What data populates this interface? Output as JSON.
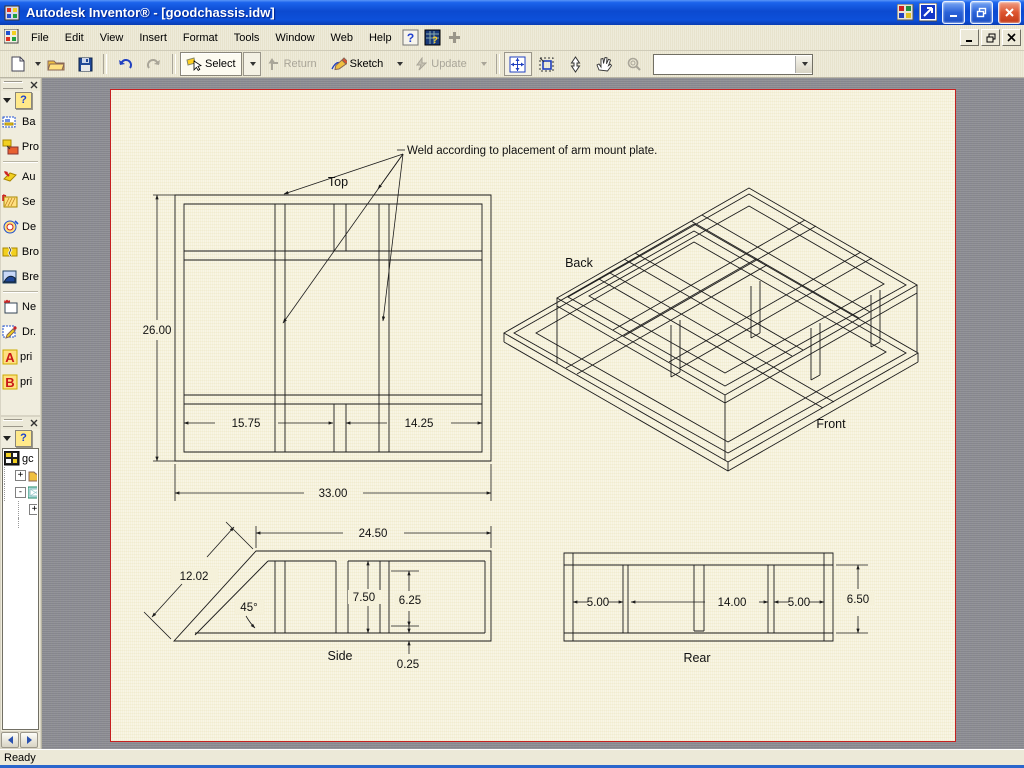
{
  "titlebar": {
    "title": "Autodesk Inventor® - [goodchassis.idw]"
  },
  "menubar": {
    "items": [
      "File",
      "Edit",
      "View",
      "Insert",
      "Format",
      "Tools",
      "Window",
      "Web",
      "Help"
    ]
  },
  "toolbar": {
    "select_label": "Select",
    "return_label": "Return",
    "sketch_label": "Sketch",
    "update_label": "Update",
    "combo_value": ""
  },
  "views_panel": {
    "help": "?",
    "items": [
      {
        "label": "Ba"
      },
      {
        "label": "Pro"
      },
      {
        "label": "Au"
      },
      {
        "label": "Se"
      },
      {
        "label": "De"
      },
      {
        "label": "Bro"
      },
      {
        "label": "Bre"
      },
      {
        "label": "Ne"
      },
      {
        "label": "Dr."
      },
      {
        "icon_text": "A",
        "label": "pri"
      },
      {
        "icon_text": "B",
        "label": "pri"
      }
    ]
  },
  "browser_panel": {
    "help": "?",
    "root_label": "gc",
    "exp1": "+",
    "exp2": "-",
    "exp3": "+"
  },
  "statusbar": {
    "text": "Ready"
  },
  "sheet": {
    "note": "Weld according to placement of arm mount plate.",
    "top_view": {
      "label": "Top",
      "dim_height": "26.00",
      "dim_bay_left": "15.75",
      "dim_bay_right": "14.25",
      "dim_width": "33.00"
    },
    "iso_view": {
      "label_back": "Back",
      "label_front": "Front"
    },
    "side_view": {
      "label": "Side",
      "dim_width": "24.50",
      "dim_diag": "12.02",
      "dim_angle": "45°",
      "dim_height": "7.50",
      "dim_inner": "6.25",
      "dim_wall": "0.25"
    },
    "rear_view": {
      "label": "Rear",
      "dim_left": "5.00",
      "dim_center": "14.00",
      "dim_right": "5.00",
      "dim_height": "6.50"
    }
  },
  "colors": {
    "titlebar_blue": "#0c4ad0",
    "sheet": "#f5f1da",
    "sheet_border": "#c62020",
    "canvas_gray": "#8d8d95",
    "chrome": "#ece9d8"
  }
}
